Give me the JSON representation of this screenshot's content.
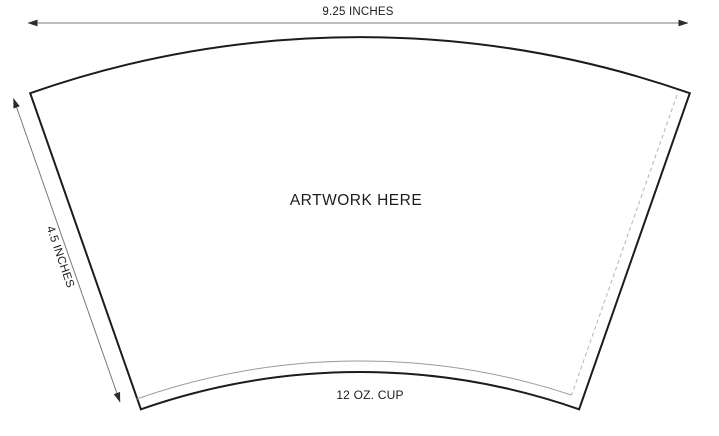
{
  "template": {
    "top_dimension_label": "9.25 INCHES",
    "side_dimension_label": "4.5 INCHES",
    "artwork_label": "ARTWORK HERE",
    "cup_label": "12 OZ. CUP",
    "colors": {
      "outline": "#1c1c1c",
      "seam_line": "#9b9b9b",
      "fold_line": "#b5b5b5",
      "dimension_line": "#7a7a7a",
      "arrowhead": "#2b2b2b",
      "text": "#1c1c1c",
      "background": "#ffffff"
    }
  }
}
